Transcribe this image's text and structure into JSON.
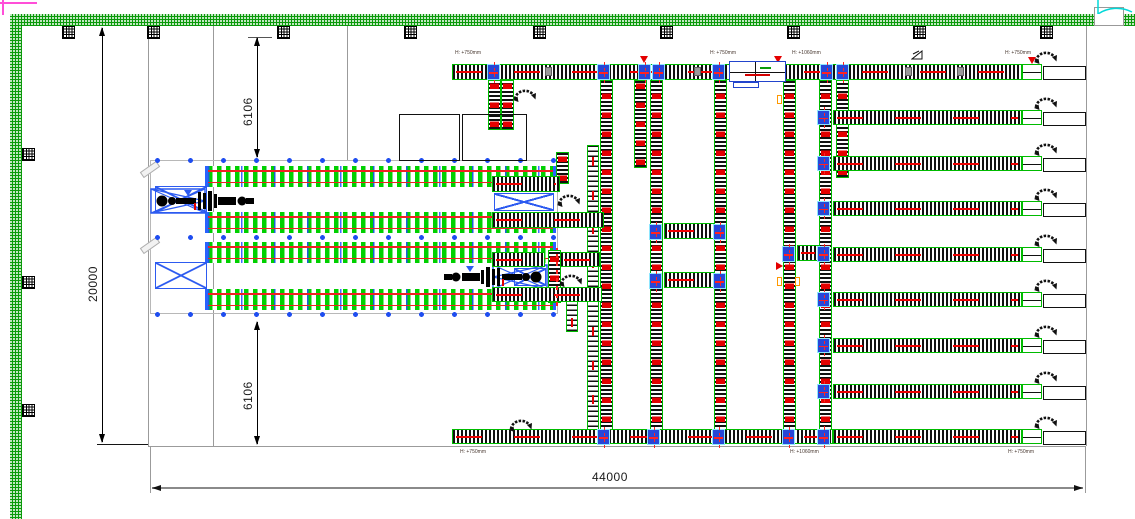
{
  "title": "warehouse-conveyor-cad-plan",
  "dimensions": {
    "total_width": "44000",
    "total_height": "20000",
    "offset_top": "6106",
    "offset_bottom": "6106"
  },
  "height_labels": [
    {
      "text": "H: +750mm",
      "x": 455,
      "y": 50
    },
    {
      "text": "H: +750mm",
      "x": 710,
      "y": 50
    },
    {
      "text": "H: +1060mm",
      "x": 792,
      "y": 50
    },
    {
      "text": "H: +750mm",
      "x": 1005,
      "y": 50
    },
    {
      "text": "H: +750mm",
      "x": 460,
      "y": 449
    },
    {
      "text": "H: +1060mm",
      "x": 790,
      "y": 449
    },
    {
      "text": "H: +750mm",
      "x": 1008,
      "y": 449
    }
  ],
  "colors": {
    "wall_green": "#0a9a0a",
    "conveyor_green": "#00bb00",
    "rack_green": "#00d000",
    "accent_red": "#ee0000",
    "frame_blue": "#2d5bf0",
    "junction_blue": "#2746d8",
    "door_cyan": "#00d8d8",
    "grid_gray": "#9b9b9b",
    "marker_orange": "#ff9900",
    "viewport_pink": "#ff4fd8"
  },
  "icons": [
    "rotary-arrow-icon",
    "slope-mark-icon",
    "column-marker",
    "door-swing-icon",
    "flow-triangle-icon",
    "stacker-crane"
  ],
  "layout": {
    "top_columns_x": [
      62,
      147,
      277,
      404,
      533,
      660,
      787,
      913,
      1040
    ],
    "left_columns_y": [
      148,
      276,
      404
    ],
    "gridlines": [
      {
        "x": 148,
        "y": 26,
        "w": 1,
        "h": 420
      },
      {
        "x": 213,
        "y": 26,
        "w": 1,
        "h": 420
      },
      {
        "x": 347,
        "y": 26,
        "w": 1,
        "h": 135
      },
      {
        "x": 1086,
        "y": 26,
        "w": 1,
        "h": 420
      },
      {
        "x": 148,
        "y": 446,
        "w": 938,
        "h": 1
      },
      {
        "x": 150,
        "y": 446,
        "w": 1,
        "h": 47
      },
      {
        "x": 1085,
        "y": 446,
        "w": 1,
        "h": 47
      }
    ],
    "vconvs": [
      {
        "x": 600,
        "y": 80,
        "h": 364
      },
      {
        "x": 650,
        "y": 80,
        "h": 364
      },
      {
        "x": 714,
        "y": 80,
        "h": 364
      },
      {
        "x": 783,
        "y": 80,
        "h": 364
      },
      {
        "x": 819,
        "y": 80,
        "h": 364
      },
      {
        "x": 488,
        "y": 80,
        "h": 50
      },
      {
        "x": 501,
        "y": 80,
        "h": 50
      },
      {
        "x": 634,
        "y": 80,
        "h": 88
      },
      {
        "x": 836,
        "y": 80,
        "h": 98
      },
      {
        "x": 556,
        "y": 152,
        "h": 32
      },
      {
        "x": 548,
        "y": 250,
        "h": 53
      }
    ],
    "ladders": [
      {
        "x": 587,
        "y": 145,
        "h": 298
      },
      {
        "x": 566,
        "y": 288,
        "h": 44
      }
    ],
    "hconvs": [
      {
        "x": 452,
        "y": 429,
        "w": 381,
        "h": 15
      },
      {
        "x": 664,
        "y": 223,
        "w": 50,
        "h": 16
      },
      {
        "x": 664,
        "y": 272,
        "w": 50,
        "h": 16
      },
      {
        "x": 797,
        "y": 245,
        "w": 22,
        "h": 16
      },
      {
        "x": 492,
        "y": 176,
        "w": 68,
        "h": 16
      },
      {
        "x": 492,
        "y": 212,
        "w": 112,
        "h": 16
      },
      {
        "x": 492,
        "y": 252,
        "w": 53,
        "h": 15
      },
      {
        "x": 560,
        "y": 252,
        "w": 40,
        "h": 15
      },
      {
        "x": 492,
        "y": 287,
        "w": 110,
        "h": 15
      }
    ],
    "lanes": [
      {
        "y": 64,
        "x": 452,
        "w": 570,
        "h": 16,
        "junc": false
      },
      {
        "y": 110
      },
      {
        "y": 156
      },
      {
        "y": 201
      },
      {
        "y": 247
      },
      {
        "y": 292
      },
      {
        "y": 338
      },
      {
        "y": 384
      },
      {
        "y": 429
      }
    ],
    "lane_default": {
      "x": 833,
      "w": 189,
      "h": 15,
      "endbox_x": 1022,
      "endbox_w": 20,
      "stage_x": 1043,
      "stage_w": 43,
      "icon_x": 1033
    },
    "juncs": [
      {
        "x": 487,
        "y": 64
      },
      {
        "x": 597,
        "y": 64
      },
      {
        "x": 638,
        "y": 64
      },
      {
        "x": 652,
        "y": 64
      },
      {
        "x": 712,
        "y": 64
      },
      {
        "x": 820,
        "y": 64
      },
      {
        "x": 836,
        "y": 64
      },
      {
        "x": 649,
        "y": 224
      },
      {
        "x": 713,
        "y": 224
      },
      {
        "x": 649,
        "y": 273
      },
      {
        "x": 713,
        "y": 273
      },
      {
        "x": 782,
        "y": 246
      },
      {
        "x": 817,
        "y": 246
      },
      {
        "x": 597,
        "y": 429
      },
      {
        "x": 647,
        "y": 429
      },
      {
        "x": 712,
        "y": 429
      },
      {
        "x": 782,
        "y": 429
      },
      {
        "x": 817,
        "y": 429
      }
    ],
    "icons_rot": [
      {
        "x": 512,
        "y": 81
      },
      {
        "x": 556,
        "y": 186
      },
      {
        "x": 558,
        "y": 266
      },
      {
        "x": 508,
        "y": 411
      }
    ],
    "tris": [
      {
        "x": 640,
        "y": 56
      },
      {
        "x": 774,
        "y": 56
      },
      {
        "x": 1028,
        "y": 57
      }
    ],
    "omarks": [
      {
        "x": 777,
        "y": 95
      },
      {
        "x": 777,
        "y": 277
      },
      {
        "x": 795,
        "y": 277
      }
    ],
    "rtris": [
      {
        "x": 776,
        "y": 262
      }
    ],
    "gmarks": [
      {
        "x": 545,
        "y": 67
      },
      {
        "x": 694,
        "y": 67
      },
      {
        "x": 758,
        "y": 67
      },
      {
        "x": 905,
        "y": 67
      },
      {
        "x": 957,
        "y": 67
      }
    ],
    "redvs": [
      {
        "x": 556,
        "y": 248,
        "h": 58
      }
    ],
    "slope_marks": [
      {
        "x": 911,
        "y": 47
      }
    ],
    "rack": {
      "frame": {
        "x": 150,
        "y": 160,
        "w": 408,
        "h": 154
      },
      "dots_y": [
        160,
        237,
        314
      ],
      "bands": [
        {
          "x": 205,
          "y": 166,
          "w": 351,
          "h": 21
        },
        {
          "x": 205,
          "y": 212,
          "w": 351,
          "h": 21
        },
        {
          "x": 205,
          "y": 242,
          "w": 351,
          "h": 21
        },
        {
          "x": 205,
          "y": 289,
          "w": 351,
          "h": 21
        }
      ],
      "xframes": [
        {
          "x": 155,
          "y": 186,
          "w": 52,
          "h": 27
        },
        {
          "x": 155,
          "y": 262,
          "w": 52,
          "h": 27
        },
        {
          "x": 494,
          "y": 193,
          "w": 60,
          "h": 18
        },
        {
          "x": 514,
          "y": 268,
          "w": 32,
          "h": 18
        }
      ],
      "cranes": [
        {
          "x": 150,
          "y": 188,
          "flip": false
        },
        {
          "x": 436,
          "y": 264,
          "flip": true
        }
      ],
      "grayangles": [
        {
          "x": 140,
          "y": 166
        },
        {
          "x": 140,
          "y": 242
        }
      ],
      "bluemarks": [
        {
          "x": 184,
          "y": 190
        },
        {
          "x": 466,
          "y": 266
        }
      ]
    },
    "outline_rects": [
      {
        "x": 399,
        "y": 114,
        "w": 61,
        "h": 47
      },
      {
        "x": 462,
        "y": 114,
        "w": 65,
        "h": 47
      }
    ]
  }
}
